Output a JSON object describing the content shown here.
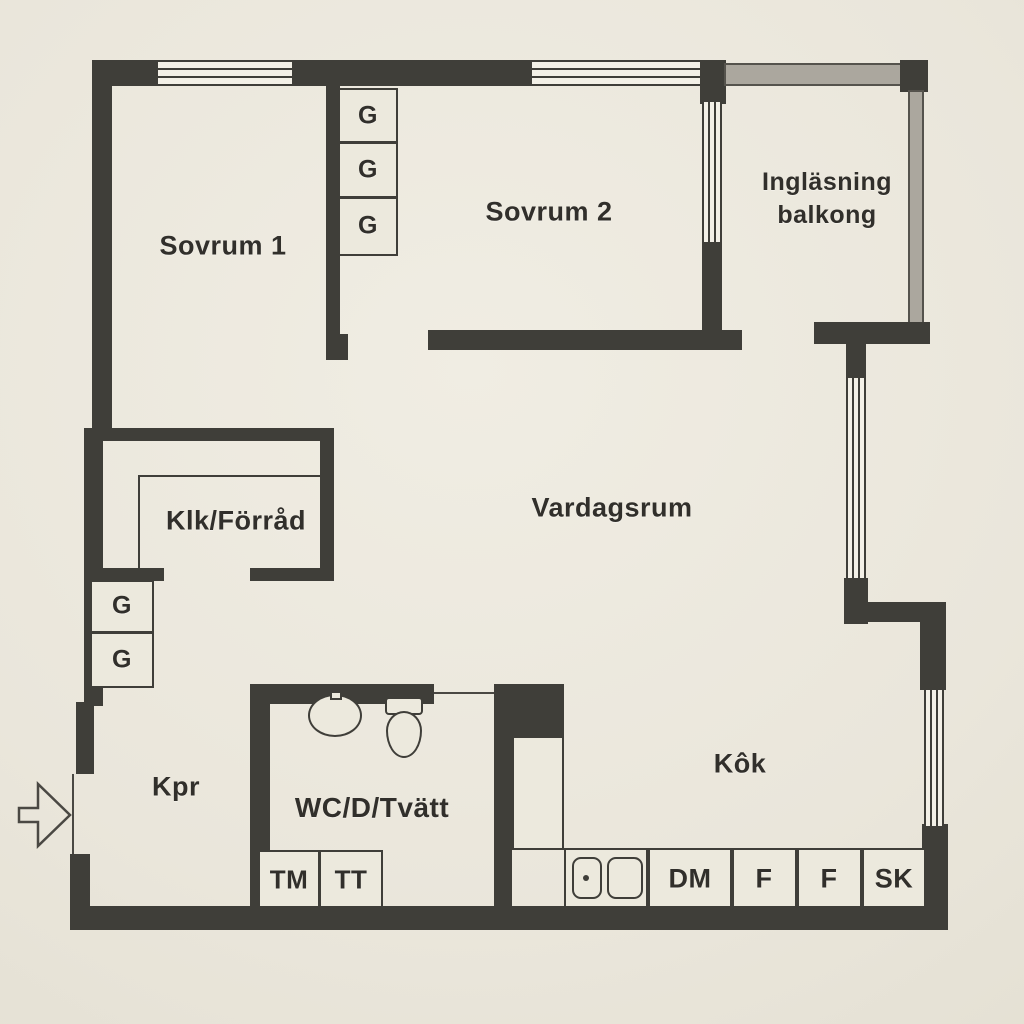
{
  "plan_type": "apartment-floor-plan",
  "rooms": {
    "sovrum1": "Sovrum 1",
    "sovrum2": "Sovrum 2",
    "balcony_line1": "Ingläsning",
    "balcony_line2": "balkong",
    "vardagsrum": "Vardagsrum",
    "klk": "Klk/Förråd",
    "kpr": "Kpr",
    "wc": "WC/D/Tvätt",
    "kok": "Kôk"
  },
  "wardrobe_label": "G",
  "appliances": {
    "tm": "TM",
    "tt": "TT",
    "dm": "DM",
    "f1": "F",
    "f2": "F",
    "sk": "SK"
  },
  "icons": {
    "entrance_arrow": "entrance-arrow"
  },
  "colors": {
    "paper": "#eae6db",
    "wall": "#3f3e39",
    "balcony_wall": "#aba79e",
    "text": "#312f2b"
  }
}
